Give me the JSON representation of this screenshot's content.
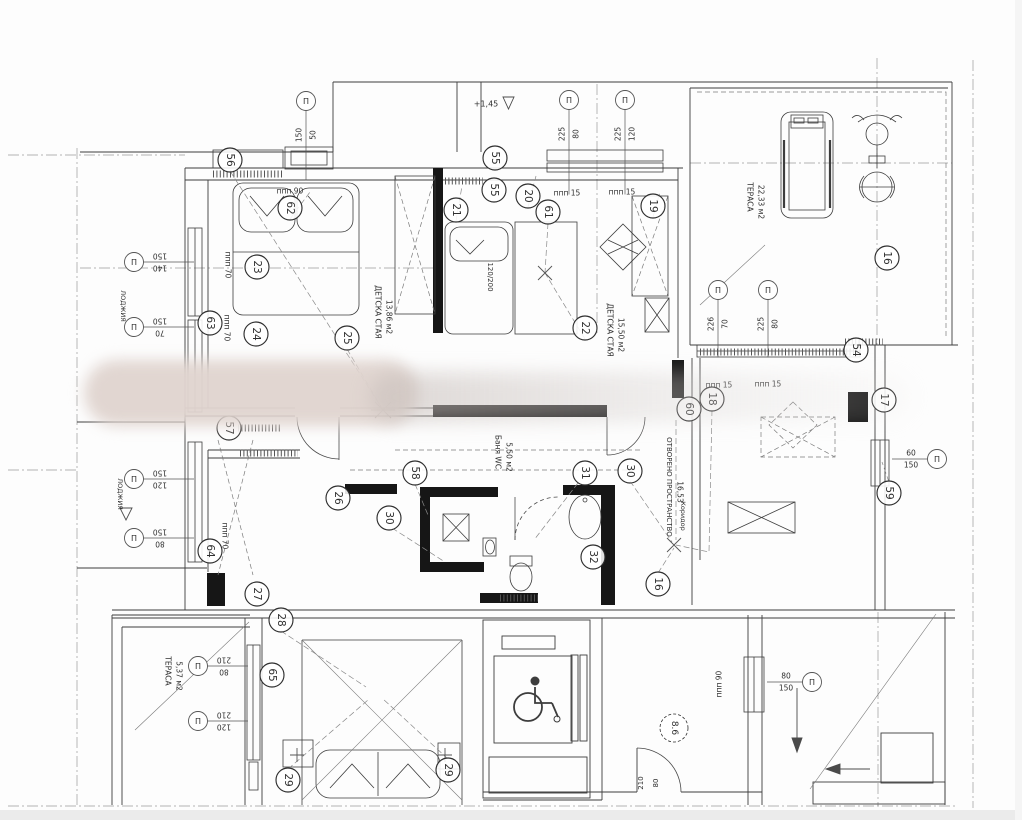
{
  "drawing": {
    "kind": "apartment electrical installation floor plan",
    "language": "Bulgarian"
  },
  "symbols": {
    "window_marker_glyph": "П"
  },
  "room_labels": [
    {
      "lines": [
        "ДЕТСКА СТАЯ",
        "13,86 м2"
      ],
      "x": 378,
      "y": 312
    },
    {
      "lines": [
        "ДЕТСКА СТАЯ",
        "15,50 м2"
      ],
      "x": 610,
      "y": 330
    },
    {
      "lines": [
        "ТЕРАСА",
        "22,33 м2"
      ],
      "x": 750,
      "y": 197
    },
    {
      "lines": [
        "ТЕРАСА",
        "5,37 м2"
      ],
      "x": 168,
      "y": 671
    },
    {
      "lines": [
        "ОТВОРЕНО ПРОСТРАНСТВО",
        "16,53"
      ],
      "x": 669,
      "y": 487
    },
    {
      "lines": [
        "Баня WC",
        "5,50 м2"
      ],
      "x": 498,
      "y": 452
    },
    {
      "lines": [
        "ЛОДЖИЯ"
      ],
      "x": 123,
      "y": 306
    },
    {
      "lines": [
        "ЛОДЖИЯ"
      ],
      "x": 120,
      "y": 494
    },
    {
      "lines": [
        "Коридор"
      ],
      "x": 683,
      "y": 516
    }
  ],
  "callouts": [
    {
      "n": "56",
      "x": 230,
      "y": 160
    },
    {
      "n": "62",
      "x": 290,
      "y": 208
    },
    {
      "n": "23",
      "x": 257,
      "y": 267
    },
    {
      "n": "63",
      "x": 210,
      "y": 323
    },
    {
      "n": "24",
      "x": 256,
      "y": 334
    },
    {
      "n": "25",
      "x": 347,
      "y": 338
    },
    {
      "n": "21",
      "x": 456,
      "y": 210
    },
    {
      "n": "55",
      "x": 495,
      "y": 158
    },
    {
      "n": "55",
      "x": 494,
      "y": 190
    },
    {
      "n": "20",
      "x": 528,
      "y": 196
    },
    {
      "n": "61",
      "x": 548,
      "y": 212
    },
    {
      "n": "19",
      "x": 653,
      "y": 206
    },
    {
      "n": "22",
      "x": 585,
      "y": 328
    },
    {
      "n": "16",
      "x": 887,
      "y": 258
    },
    {
      "n": "54",
      "x": 856,
      "y": 350
    },
    {
      "n": "60",
      "x": 689,
      "y": 409
    },
    {
      "n": "18",
      "x": 712,
      "y": 399
    },
    {
      "n": "17",
      "x": 884,
      "y": 400
    },
    {
      "n": "59",
      "x": 889,
      "y": 493
    },
    {
      "n": "57",
      "x": 229,
      "y": 428
    },
    {
      "n": "58",
      "x": 415,
      "y": 473
    },
    {
      "n": "26",
      "x": 338,
      "y": 498
    },
    {
      "n": "30",
      "x": 389,
      "y": 518
    },
    {
      "n": "31",
      "x": 585,
      "y": 473
    },
    {
      "n": "30",
      "x": 630,
      "y": 471
    },
    {
      "n": "32",
      "x": 593,
      "y": 557
    },
    {
      "n": "16",
      "x": 658,
      "y": 584
    },
    {
      "n": "64",
      "x": 210,
      "y": 551
    },
    {
      "n": "27",
      "x": 257,
      "y": 594
    },
    {
      "n": "28",
      "x": 281,
      "y": 620
    },
    {
      "n": "65",
      "x": 272,
      "y": 675
    },
    {
      "n": "29",
      "x": 288,
      "y": 780
    },
    {
      "n": "29",
      "x": 448,
      "y": 770
    },
    {
      "n": "8.6",
      "x": 674,
      "y": 728,
      "dashed": true
    }
  ],
  "window_markers": [
    {
      "dims": [
        "150",
        "50"
      ],
      "x": 306,
      "y": 101,
      "leader": "down",
      "len": 70,
      "dimrot": -90
    },
    {
      "dims": [
        "225",
        "80"
      ],
      "x": 569,
      "y": 100,
      "leader": "down",
      "len": 85,
      "dimrot": -90
    },
    {
      "dims": [
        "225",
        "120"
      ],
      "x": 625,
      "y": 100,
      "leader": "down",
      "len": 85,
      "dimrot": -90
    },
    {
      "dims": [
        "226",
        "70"
      ],
      "x": 718,
      "y": 290,
      "leader": "down",
      "len": 58,
      "dimrot": -90
    },
    {
      "dims": [
        "225",
        "80"
      ],
      "x": 768,
      "y": 290,
      "leader": "down",
      "len": 58,
      "dimrot": -90
    },
    {
      "dims": [
        "150",
        "140"
      ],
      "x": 134,
      "y": 262,
      "leader": "right",
      "len": 60,
      "dimrot": 180
    },
    {
      "dims": [
        "150",
        "70"
      ],
      "x": 134,
      "y": 327,
      "leader": "right",
      "len": 60,
      "dimrot": 180
    },
    {
      "dims": [
        "150",
        "120"
      ],
      "x": 134,
      "y": 479,
      "leader": "right",
      "len": 60,
      "dimrot": 180
    },
    {
      "dims": [
        "150",
        "80"
      ],
      "x": 134,
      "y": 538,
      "leader": "right",
      "len": 60,
      "dimrot": 180
    },
    {
      "dims": [
        "210",
        "80"
      ],
      "x": 198,
      "y": 666,
      "leader": "right",
      "len": 50,
      "dimrot": 180
    },
    {
      "dims": [
        "210",
        "120"
      ],
      "x": 198,
      "y": 721,
      "leader": "right",
      "len": 50,
      "dimrot": 180
    },
    {
      "dims": [
        "60",
        "150"
      ],
      "x": 937,
      "y": 459,
      "leader": "left",
      "len": 45,
      "dimrot": 0
    },
    {
      "dims": [
        "80",
        "150"
      ],
      "x": 812,
      "y": 682,
      "leader": "left",
      "len": 45,
      "dimrot": 0
    }
  ],
  "ppp_labels": [
    {
      "t": "ппп 90",
      "x": 290,
      "y": 191,
      "rot": 0
    },
    {
      "t": "ппп 70",
      "x": 228,
      "y": 265,
      "rot": 90
    },
    {
      "t": "ппп 70",
      "x": 227,
      "y": 328,
      "rot": 90
    },
    {
      "t": "ппп 70",
      "x": 225,
      "y": 536,
      "rot": 90
    },
    {
      "t": "ппп 15",
      "x": 567,
      "y": 193,
      "rot": 0
    },
    {
      "t": "ппп 15",
      "x": 622,
      "y": 192,
      "rot": 0
    },
    {
      "t": "ппп 15",
      "x": 719,
      "y": 385,
      "rot": 0
    },
    {
      "t": "ппп 15",
      "x": 768,
      "y": 384,
      "rot": 0
    },
    {
      "t": "ппп 90",
      "x": 719,
      "y": 684,
      "rot": -90
    }
  ],
  "misc_texts": [
    {
      "t": "+1,45",
      "x": 486,
      "y": 104,
      "rot": 0,
      "size": 8
    },
    {
      "t": "120/200",
      "x": 490,
      "y": 277,
      "rot": 90,
      "size": 7
    },
    {
      "t": "210",
      "x": 641,
      "y": 783,
      "rot": -90,
      "size": 7
    },
    {
      "t": "80",
      "x": 656,
      "y": 783,
      "rot": -90,
      "size": 7
    }
  ],
  "colors": {
    "wall": "#3d3d3d",
    "black_wall": "#161616",
    "leader": "#8a8a8a",
    "grid": "#9a9a9a",
    "text": "#2f2f2f"
  }
}
